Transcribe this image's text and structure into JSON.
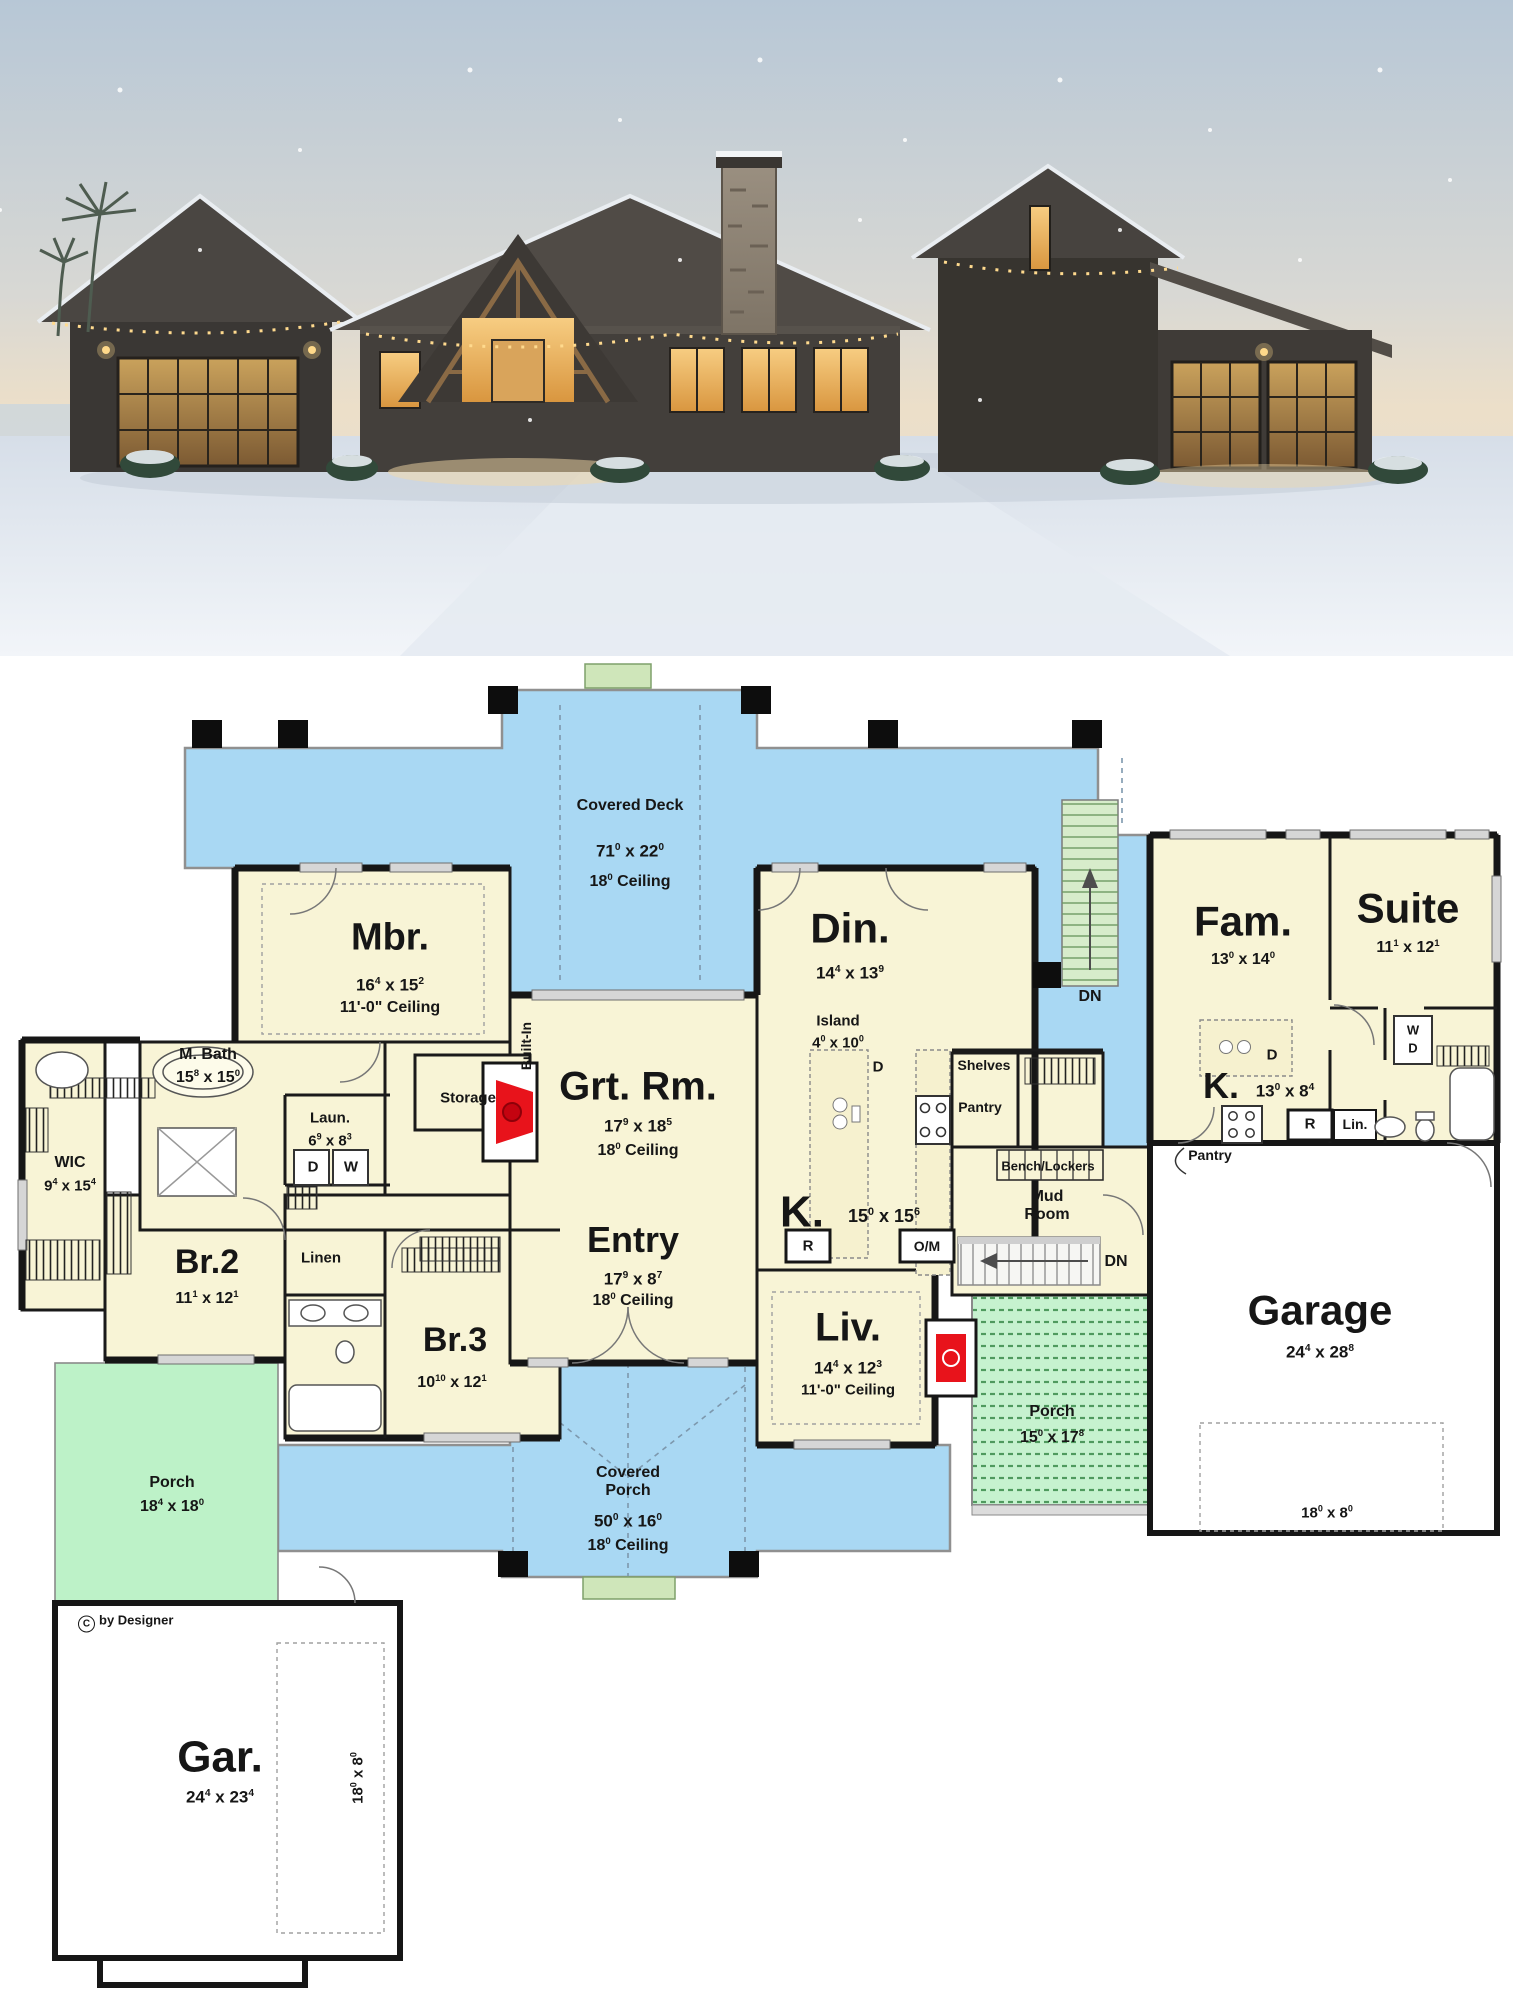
{
  "photo": {
    "alt": "Modern farmhouse exterior at dusk in snow with lit glass garage doors, timber entry gable and stone chimney"
  },
  "plan": {
    "copyright": "by Designer",
    "colors": {
      "deck_blue": "#a9d8f3",
      "room_cream": "#f8f4d6",
      "porch_green": "#bdf2c8",
      "stair_green": "#d7eccb",
      "wall_black": "#161616",
      "fireplace_red": "#e8131b",
      "garage_white": "#ffffff"
    },
    "rooms": {
      "covered_deck": {
        "label": "Covered Deck",
        "dims": "71^0 x 22^0",
        "ceiling": "18^0 Ceiling"
      },
      "mbr": {
        "label": "Mbr.",
        "dims": "16^4 x 15^2",
        "ceiling": "11'-0\" Ceiling"
      },
      "m_bath": {
        "label": "M. Bath",
        "dims": "15^8 x 15^0"
      },
      "wic": {
        "label": "WIC",
        "dims": "9^4 x 15^4"
      },
      "laun": {
        "label": "Laun.",
        "dims": "6^9 x 8^3"
      },
      "storage": {
        "label": "Storage"
      },
      "grt_rm": {
        "label": "Grt. Rm.",
        "dims": "17^9 x 18^5",
        "ceiling": "18^0 Ceiling"
      },
      "entry": {
        "label": "Entry",
        "dims": "17^9 x 8^7",
        "ceiling": "18^0 Ceiling"
      },
      "din": {
        "label": "Din.",
        "dims": "14^4 x 13^9"
      },
      "island": {
        "label": "Island",
        "dims": "4^0 x 10^0"
      },
      "kitchen": {
        "label": "K.",
        "dims": "15^0 x 15^6"
      },
      "liv": {
        "label": "Liv.",
        "dims": "14^4 x 12^3",
        "ceiling": "11'-0\" Ceiling"
      },
      "br2": {
        "label": "Br.2",
        "dims": "11^1 x 12^1"
      },
      "br3": {
        "label": "Br.3",
        "dims": "10^10 x 12^1"
      },
      "linen": {
        "label": "Linen"
      },
      "shelves": {
        "label": "Shelves"
      },
      "pantry_main": {
        "label": "Pantry"
      },
      "bench_lockers": {
        "label": "Bench/Lockers"
      },
      "mud_room": {
        "label": "Mud Room"
      },
      "fam": {
        "label": "Fam.",
        "dims": "13^0 x 14^0"
      },
      "suite": {
        "label": "Suite",
        "dims": "11^1 x 12^1"
      },
      "kitchen2": {
        "label": "K.",
        "dims": "13^0 x 8^4"
      },
      "lin2": {
        "label": "Lin."
      },
      "pantry2": {
        "label": "Pantry"
      },
      "garage_right": {
        "label": "Garage",
        "dims": "24^4 x 28^8",
        "door": "18^0 x 8^0"
      },
      "porch_right": {
        "label": "Porch",
        "dims": "15^0 x 17^8"
      },
      "porch_left": {
        "label": "Porch",
        "dims": "18^4 x 18^0"
      },
      "covered_porch": {
        "label": "Covered Porch",
        "dims": "50^0 x 16^0",
        "ceiling": "18^0 Ceiling"
      },
      "gar_bottom": {
        "label": "Gar.",
        "dims": "24^4 x 23^4",
        "door": "18^0 x 8^0"
      }
    },
    "markers": {
      "dn": "DN",
      "r": "R",
      "om": "O/M",
      "d": "D",
      "w": "W",
      "wd_w": "W",
      "wd_d": "D",
      "built_in": "Built-In"
    }
  }
}
